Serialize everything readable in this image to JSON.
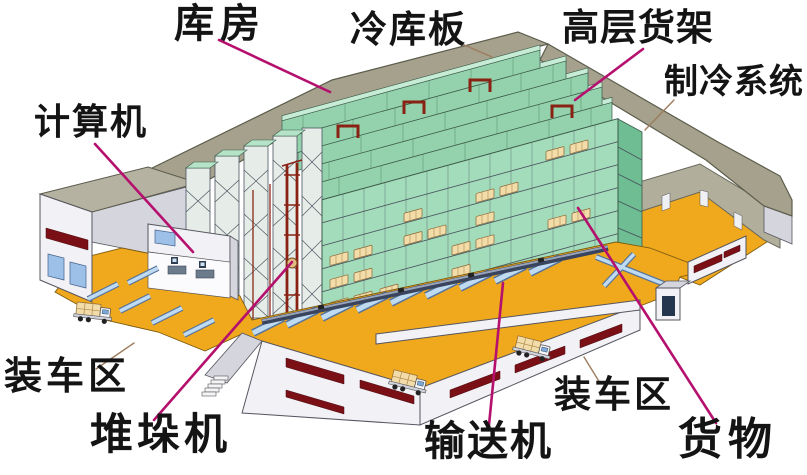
{
  "labels": {
    "warehouse": "库房",
    "cold_panel": "冷库板",
    "racks": "高层货架",
    "refrigeration": "制冷系统",
    "computer": "计算机",
    "loading_left": "装车区",
    "stacker": "堆垛机",
    "conveyor": "输送机",
    "loading_right": "装车区",
    "goods": "货物"
  },
  "colors": {
    "leader_magenta": "#b5106e",
    "leader_brown": "#9c7c5e",
    "roof": "#a5a18c",
    "rack_green": "#a3dcba",
    "floor_orange": "#f0a81c",
    "window_red": "#7a1016",
    "conveyor_blue": "#bfdbf2",
    "goods_tan": "#f2dcaa",
    "crane_red": "#8a2214"
  }
}
